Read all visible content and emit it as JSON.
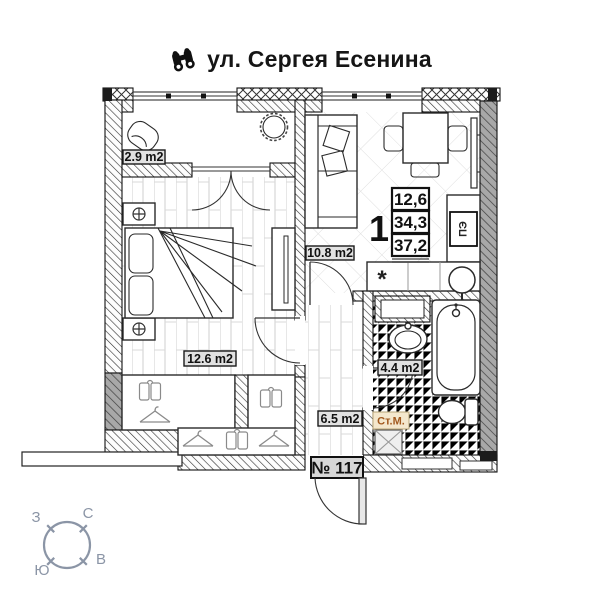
{
  "title": "ул. Сергея Есенина",
  "plan": {
    "apartment_number": "№ 117",
    "areas": {
      "balcony": "2.9 m2",
      "bedroom": "12.6 m2",
      "kitchen_living": "10.8 m2",
      "bathroom": "4.4 m2",
      "hallway": "6.5 m2"
    },
    "summary": {
      "rooms_count": "1",
      "values": [
        "12,6",
        "34,3",
        "37,2"
      ]
    },
    "appliances": {
      "stove": "ПЭ",
      "washing_machine": "Ст.М.",
      "sink_symbol": "*"
    }
  },
  "compass": {
    "north": "С",
    "south": "Ю",
    "west": "З",
    "east": "В"
  },
  "colors": {
    "line": "#1a1a1a",
    "washing_machine_text": "#a2591f",
    "washing_machine_bg": "#f4e7cd",
    "label_bg": "#e2e2e2",
    "number_bg": "#d7d7d7",
    "compass": "#8b95a6"
  }
}
